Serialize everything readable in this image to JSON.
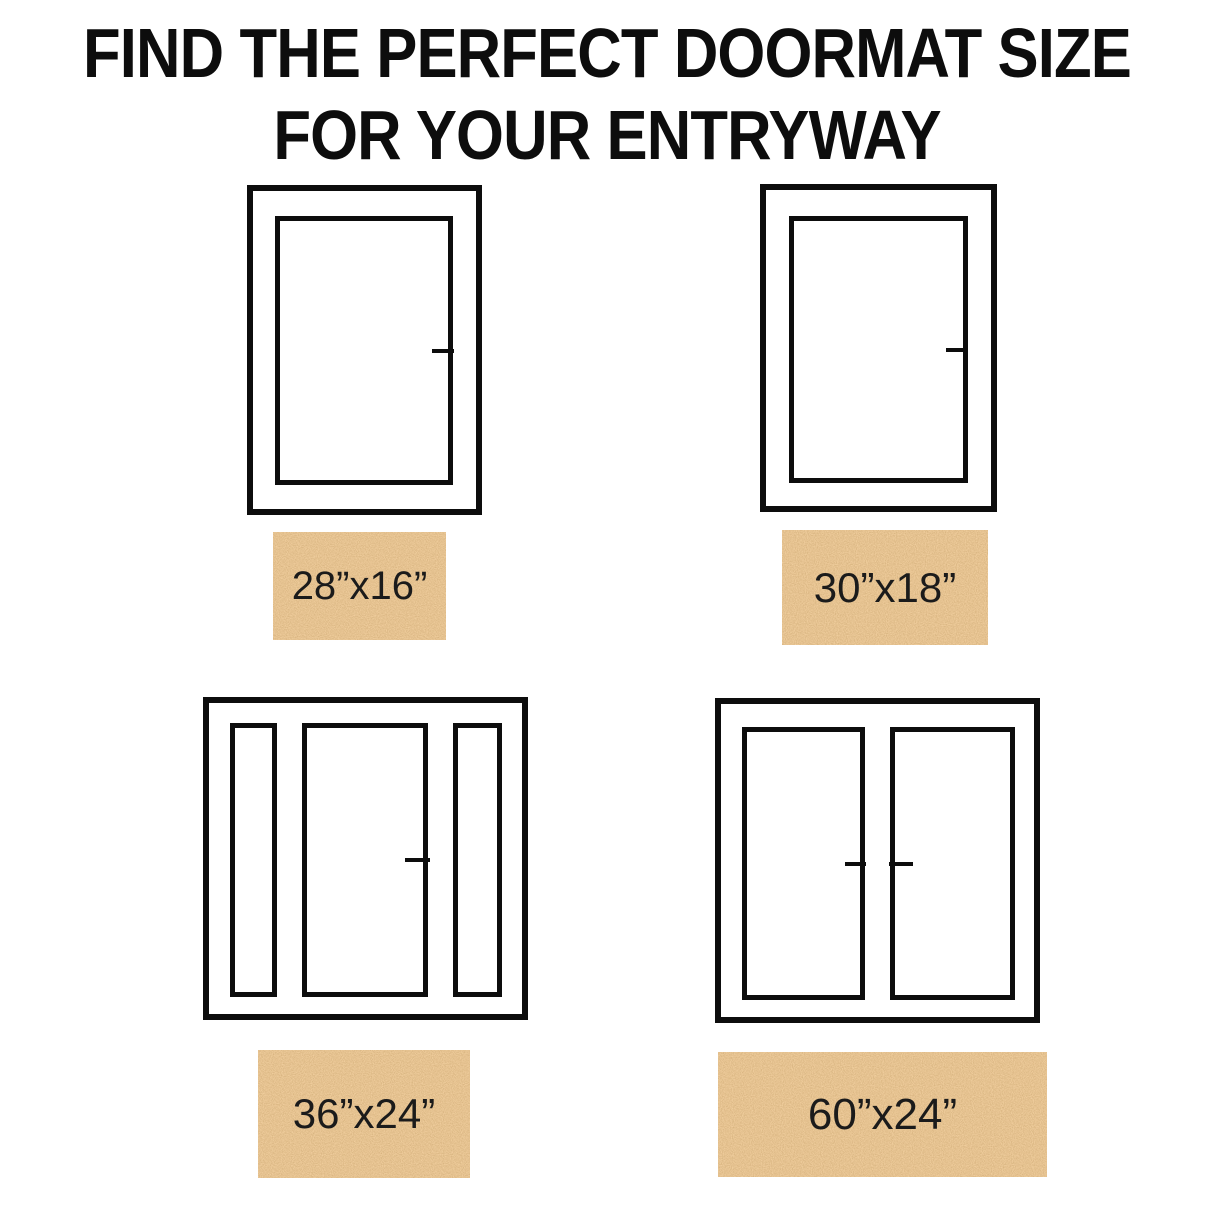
{
  "title": {
    "line1": "FIND THE PERFECT DOORMAT SIZE",
    "line2": "FOR YOUR ENTRYWAY"
  },
  "colors": {
    "background": "#ffffff",
    "outline": "#0d0d0d",
    "title_text": "#0d0d0d",
    "mat_base": "#c7874a",
    "mat_label_text": "#1b1b1b"
  },
  "diagrams": [
    {
      "door_type": "single-door",
      "mat_label": "28”x16”"
    },
    {
      "door_type": "single-door",
      "mat_label": "30”x18”"
    },
    {
      "door_type": "door-with-sidelights",
      "mat_label": "36”x24”"
    },
    {
      "door_type": "double-door",
      "mat_label": "60”x24”"
    }
  ]
}
